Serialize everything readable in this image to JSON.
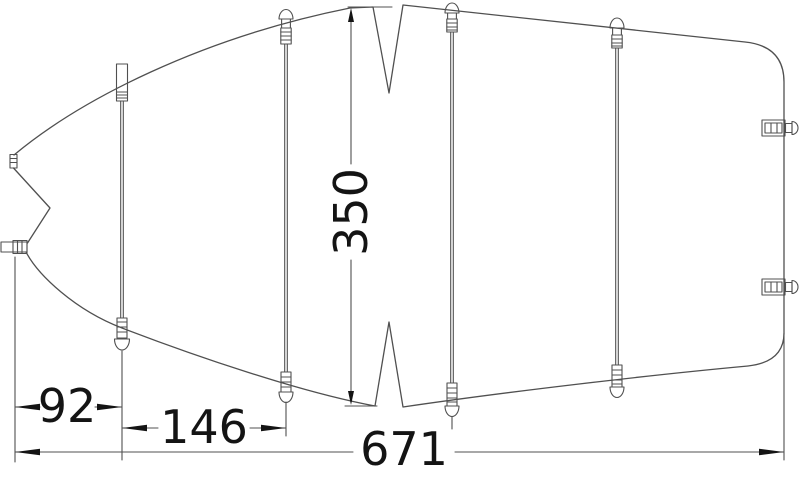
{
  "drawing": {
    "background_color": "#ffffff",
    "line_color": "#505050",
    "label_color": "#141414",
    "dimension_labels": {
      "beam_width": "350",
      "bow_to_first_pole": "92",
      "first_to_second_pole": "146",
      "overall_length": "671"
    }
  }
}
